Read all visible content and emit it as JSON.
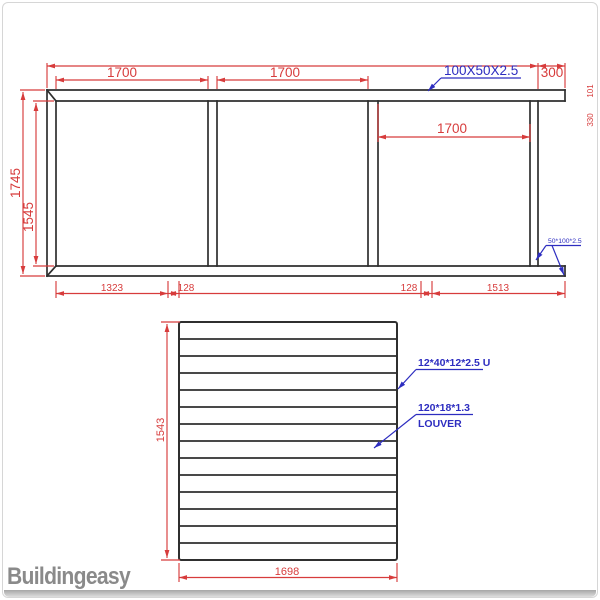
{
  "colors": {
    "dimension_red": "#d73c3c",
    "callout_blue": "#2d2dc0",
    "line_black": "#2f2f2f",
    "watermark_gray": "#8a8a8a"
  },
  "elevation": {
    "bay1_dim": "1700",
    "bay2_dim": "1700",
    "bay3_dim": "1700",
    "overhang_dim": "300",
    "beam_callout": "100X50X2.5",
    "post_callout": "50*100*2.5",
    "outer_height_dim": "1745",
    "inner_height_dim": "1545",
    "edge_dim_top": "101",
    "edge_dim_bottom": "330",
    "bottom_dims": [
      "1323",
      "128",
      "128",
      "1513"
    ]
  },
  "louver": {
    "height_dim": "1543",
    "width_dim": "1698",
    "u_channel_callout": "12*40*12*2.5 U",
    "slat_callout": "120*18*1.3",
    "slat_callout_label": "LOUVER",
    "slat_count": 14
  },
  "watermark": {
    "brand_part1": "Building",
    "brand_part2": "easy"
  }
}
